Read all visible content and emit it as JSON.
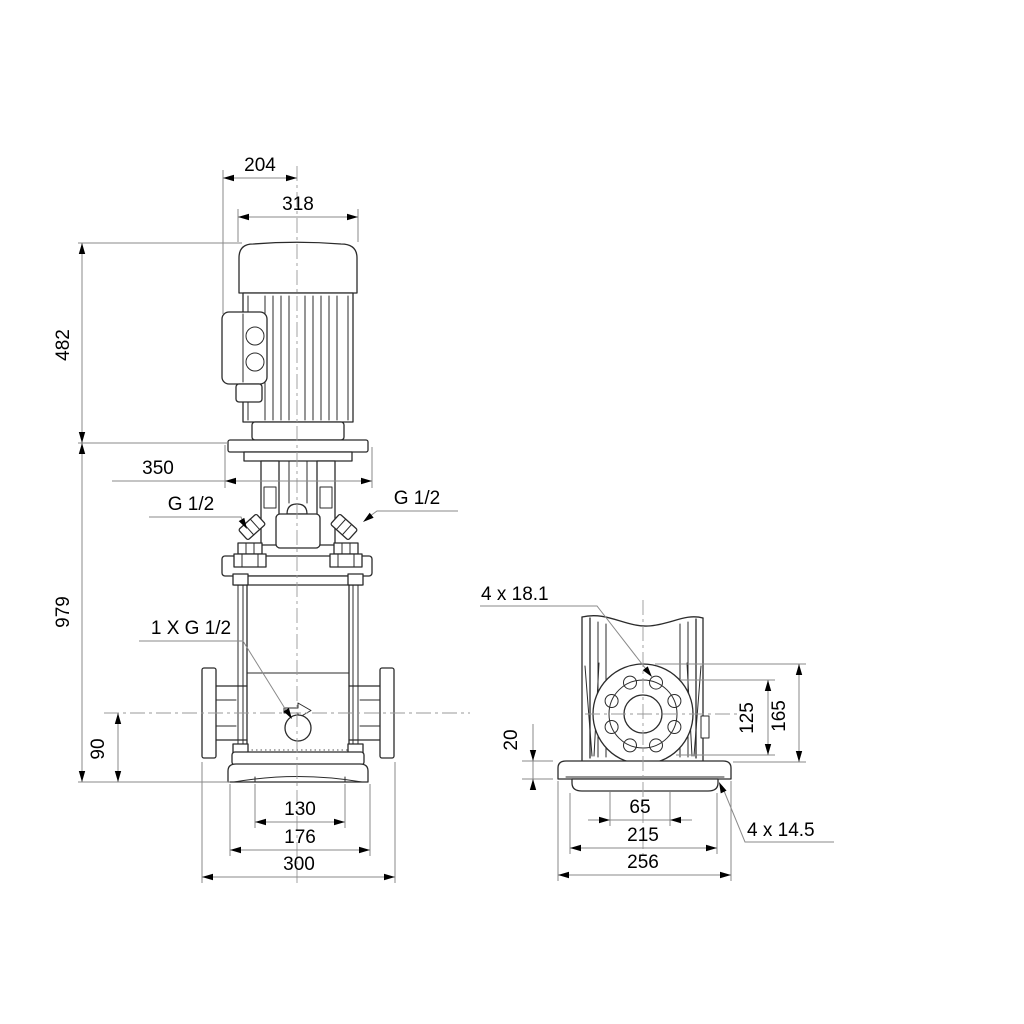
{
  "drawing_title": "Vertical multistage centrifugal pump - dimensional drawing",
  "colors": {
    "background": "#ffffff",
    "outline": "#2b2b2b",
    "dimension_lines": "#8a8a8a",
    "text": "#000000"
  },
  "front_view": {
    "dims": {
      "top_width": "204",
      "motor_width": "318",
      "motor_height": "482",
      "total_height": "979",
      "depth": "350",
      "port_height": "90",
      "pedestal_width": "130",
      "base_width": "176",
      "port_to_port": "300"
    },
    "labels": {
      "plug_left": "G 1/2",
      "plug_right": "G 1/2",
      "drain_port": "1 X G 1/2"
    }
  },
  "side_view": {
    "dims": {
      "base_plate_thickness": "20",
      "bolt_span": "125",
      "flange_top_height": "165",
      "slot_spacing": "65",
      "hole_spacing": "215",
      "base_length": "256"
    },
    "labels": {
      "flange_holes": "4 x 18.1",
      "base_holes": "4 x 14.5"
    }
  }
}
